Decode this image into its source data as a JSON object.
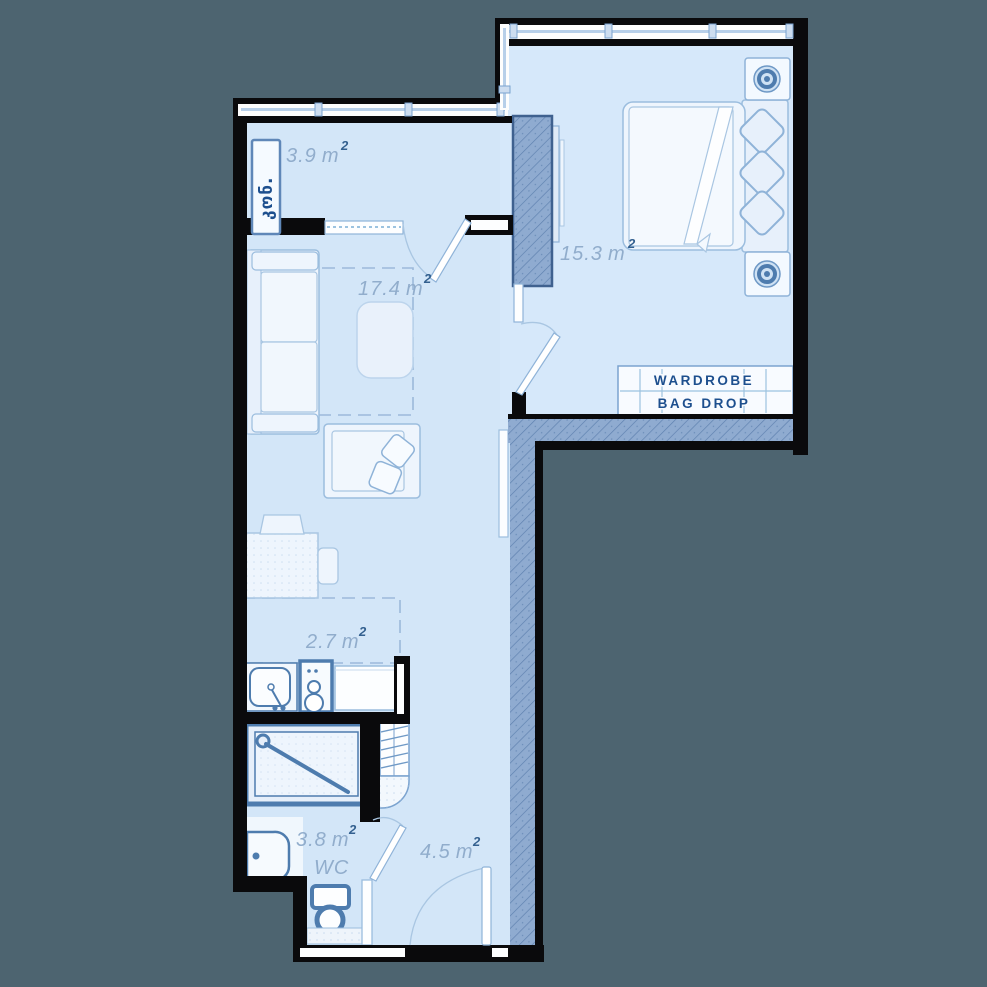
{
  "background_color": "#4d6470",
  "plan": {
    "rooms": {
      "balcony": {
        "area": "3.9",
        "unit": "m",
        "sup": "2"
      },
      "living_room": {
        "area": "17.4",
        "unit": "m",
        "sup": "2"
      },
      "bedroom": {
        "area": "15.3",
        "unit": "m",
        "sup": "2"
      },
      "kitchen": {
        "area": "2.7",
        "unit": "m",
        "sup": "2"
      },
      "bathroom": {
        "area": "3.8",
        "unit": "m",
        "sup": "2",
        "label": "WC"
      },
      "hallway": {
        "area": "4.5",
        "unit": "m",
        "sup": "2"
      }
    },
    "storage": {
      "line1": "WARDROBE",
      "line2": "BAG DROP"
    },
    "balcony_unit_label": "კონ.",
    "colors": {
      "floor": "#d3e6f8",
      "wall": "#0a0a0c",
      "hatch_wall": "#8fabd0",
      "accent_dark": "#4e7cae",
      "area_label": "#91adcc",
      "text_navy": "#1d4f8e"
    }
  }
}
